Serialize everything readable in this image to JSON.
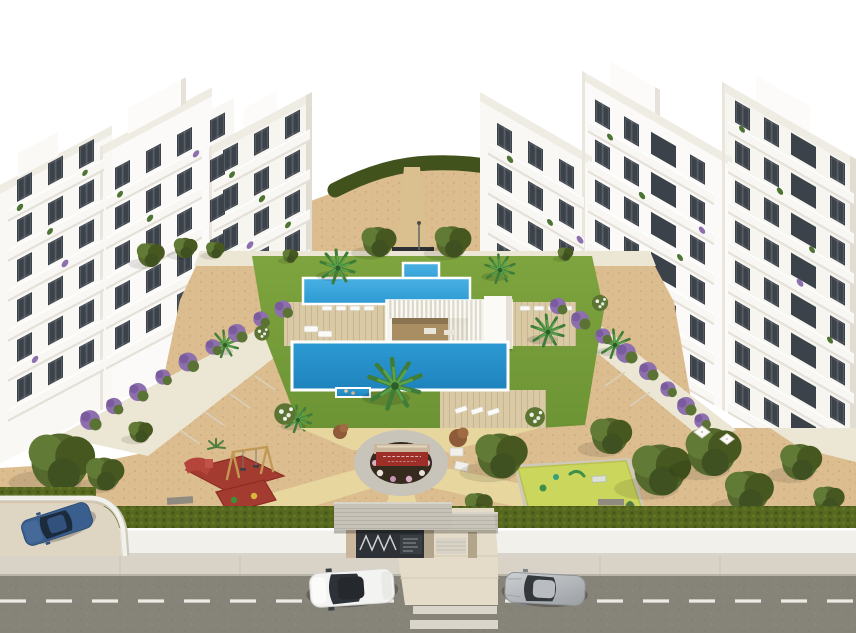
{
  "scene": {
    "kind": "3d-architectural-render",
    "view": "aerial",
    "subject": "White Mediterranean apartment complex with communal swimming pools, landscaped gardens, playground, activity lawn and a gated street entrance with parked cars"
  },
  "colors": {
    "sky": "#ffffff",
    "building": "#f9f8f5",
    "buildingShade": "#e2ddd3",
    "roofDeck": "#efece4",
    "window": "#3c4249",
    "railing": "#f8f7f3",
    "slab": "#e4e0d8",
    "lawn": "#7ea43f",
    "lawnDark": "#6d9434",
    "hedge": "#42521c",
    "streetHedge": "#57691f",
    "sand": "#dcbd8f",
    "sandDot": "#c7a677",
    "path": "#e7d79e",
    "walkway": "#ece6d4",
    "deck": "#d9c9a5",
    "wood": "#a98d63",
    "poolLight": "#49b0e2",
    "pool": "#2d9ad3",
    "poolDeep": "#1f83bd",
    "plazaRing": "#c8c4ba",
    "plazaSoil": "#36291d",
    "signRed": "#9e2f28",
    "stone": "#c9b69c",
    "matRed": "#a43b30",
    "turfYellow": "#cbd65c",
    "treeOlive": "#55682e",
    "treeDark": "#46571f",
    "palmGreen": "#3f7c38",
    "flowerPurple": "#8d6fae",
    "flowerPink": "#d9aec6",
    "wallWhite": "#f2f0ea",
    "sidewalk": "#d9d3c7",
    "road": "#868379",
    "roadMark": "#eceae4",
    "driveway": "#e4dcc9",
    "gateDark": "#2e3236",
    "gateRoof": "#c6c2b8",
    "carBlue": "#3a5f8e",
    "carWhite": "#f3f3f2",
    "carSilver": "#b9bdc1"
  },
  "inventory": [
    "left-apartment-building",
    "right-apartment-building",
    "hedge-hill",
    "upper-pool",
    "kids-pool",
    "main-pool",
    "pool-pavilion",
    "sun-loungers",
    "palm-trees",
    "central-plaza",
    "monument-sign",
    "playground",
    "swing-set",
    "playground-slide",
    "activity-lawn",
    "garden-trees",
    "bougainvillea-rows",
    "perimeter-hedge",
    "boundary-wall",
    "sidewalk",
    "road",
    "lane-markings",
    "crosswalk",
    "driveway",
    "entrance-gate",
    "gate-canopy",
    "parking-bay",
    "parked-blue-car",
    "white-suv-car",
    "silver-coupe-car"
  ]
}
